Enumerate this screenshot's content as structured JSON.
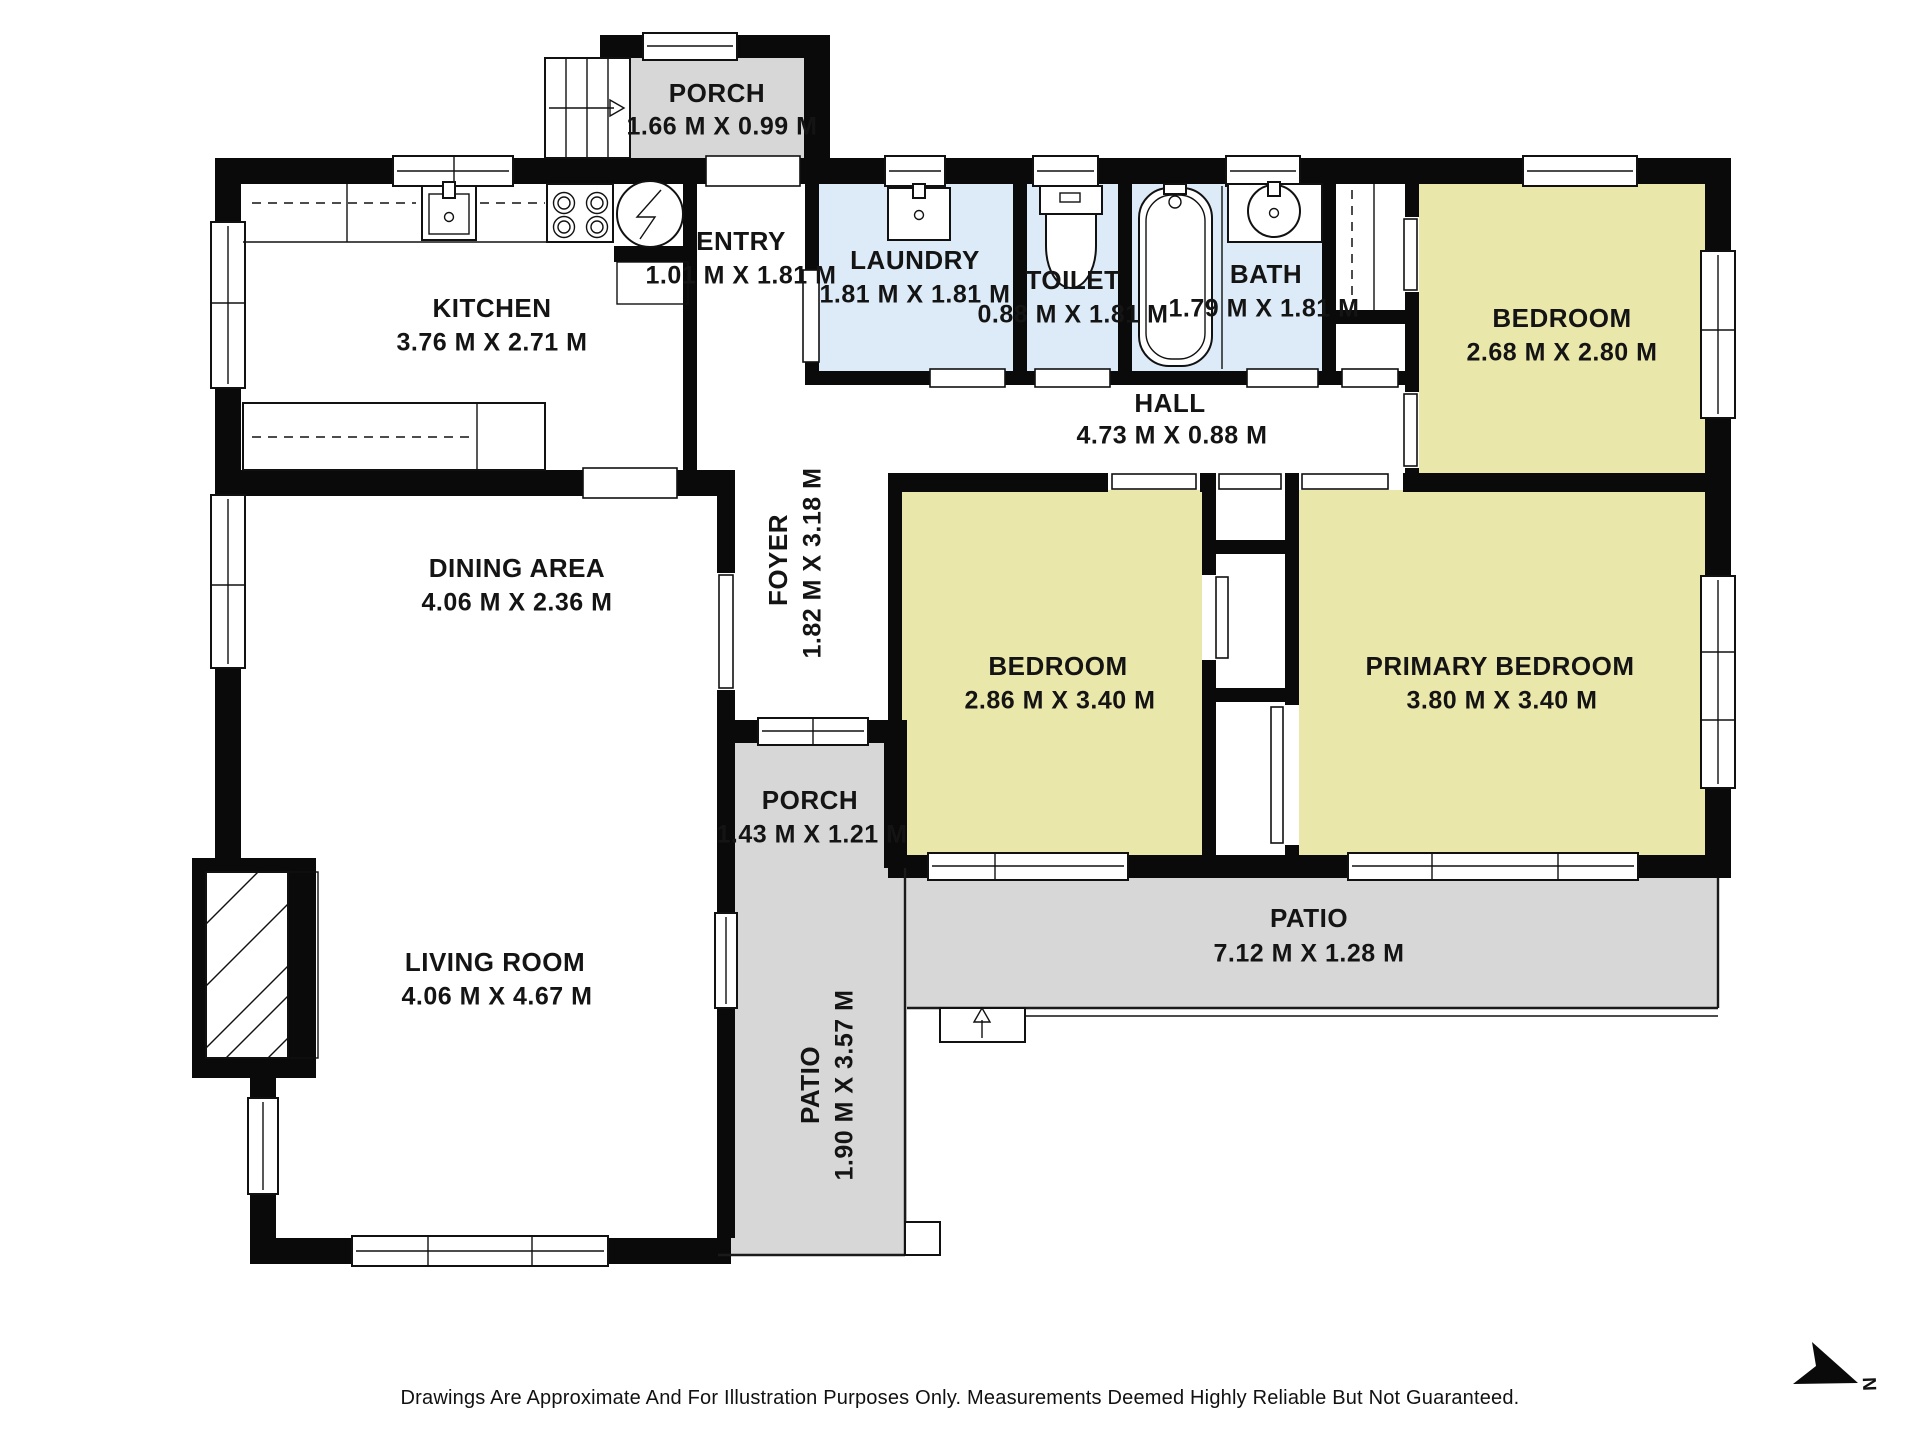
{
  "rooms": {
    "porch_top": {
      "name": "PORCH",
      "dims": "1.66 M X 0.99 M"
    },
    "kitchen": {
      "name": "KITCHEN",
      "dims": "3.76 M X 2.71 M"
    },
    "entry": {
      "name": "ENTRY",
      "dims": "1.01 M X 1.81 M"
    },
    "laundry": {
      "name": "LAUNDRY",
      "dims": "1.81 M X 1.81 M"
    },
    "toilet": {
      "name": "TOILET",
      "dims": "0.88 M X 1.81 M"
    },
    "bath": {
      "name": "BATH",
      "dims": "1.79 M X 1.81 M"
    },
    "bedroom_top": {
      "name": "BEDROOM",
      "dims": "2.68 M X 2.80 M"
    },
    "hall": {
      "name": "HALL",
      "dims": "4.73 M X 0.88 M"
    },
    "foyer": {
      "name": "FOYER",
      "dims": "1.82 M X 3.18 M"
    },
    "dining": {
      "name": "DINING AREA",
      "dims": "4.06 M X 2.36 M"
    },
    "bedroom_mid": {
      "name": "BEDROOM",
      "dims": "2.86 M X 3.40 M"
    },
    "primary": {
      "name": "PRIMARY BEDROOM",
      "dims": "3.80 M X 3.40 M"
    },
    "porch_mid": {
      "name": "PORCH",
      "dims": "1.43 M X 1.21 M"
    },
    "patio_side": {
      "name": "PATIO",
      "dims": "1.90 M X 3.57 M"
    },
    "patio_rear": {
      "name": "PATIO",
      "dims": "7.12 M X 1.28 M"
    },
    "living": {
      "name": "LIVING ROOM",
      "dims": "4.06 M X 4.67 M"
    }
  },
  "compass": {
    "label": "N"
  },
  "disclaimer": "Drawings Are Approximate And For Illustration Purposes Only. Measurements Deemed Highly Reliable But Not Guaranteed.",
  "colors": {
    "bedroom": "#eae7ab",
    "wet_room": "#dcebf7",
    "outdoor": "#d7d7d7",
    "wall": "#0a0a0a"
  }
}
